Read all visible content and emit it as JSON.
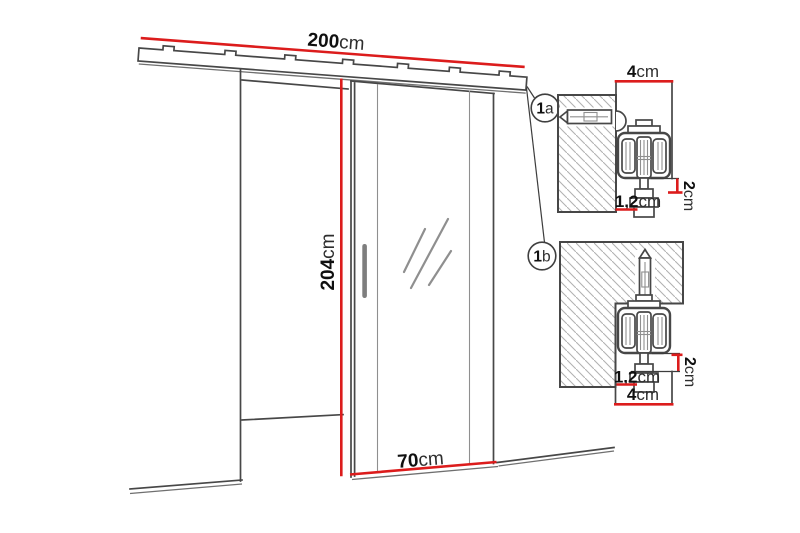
{
  "colors": {
    "dimension_red": "#dc1c1c",
    "line_dark": "#474747",
    "hatch_gray": "#b2b2b2"
  },
  "main_view": {
    "rail_width": {
      "value": "200",
      "unit": "cm"
    },
    "door_height": {
      "value": "204",
      "unit": "cm"
    },
    "door_width": {
      "value": "70",
      "unit": "cm"
    }
  },
  "callouts": {
    "a": {
      "number": "1",
      "letter": "a"
    },
    "b": {
      "number": "1",
      "letter": "b"
    }
  },
  "detail_a": {
    "track_width": {
      "value": "4",
      "unit": "cm"
    },
    "drop": {
      "value": "2",
      "unit": "cm"
    },
    "offset": {
      "value": "1,2",
      "unit": "cm"
    }
  },
  "detail_b": {
    "drop": {
      "value": "2",
      "unit": "cm"
    },
    "offset": {
      "value": "1,2",
      "unit": "cm"
    },
    "track_width": {
      "value": "4",
      "unit": "cm"
    }
  }
}
